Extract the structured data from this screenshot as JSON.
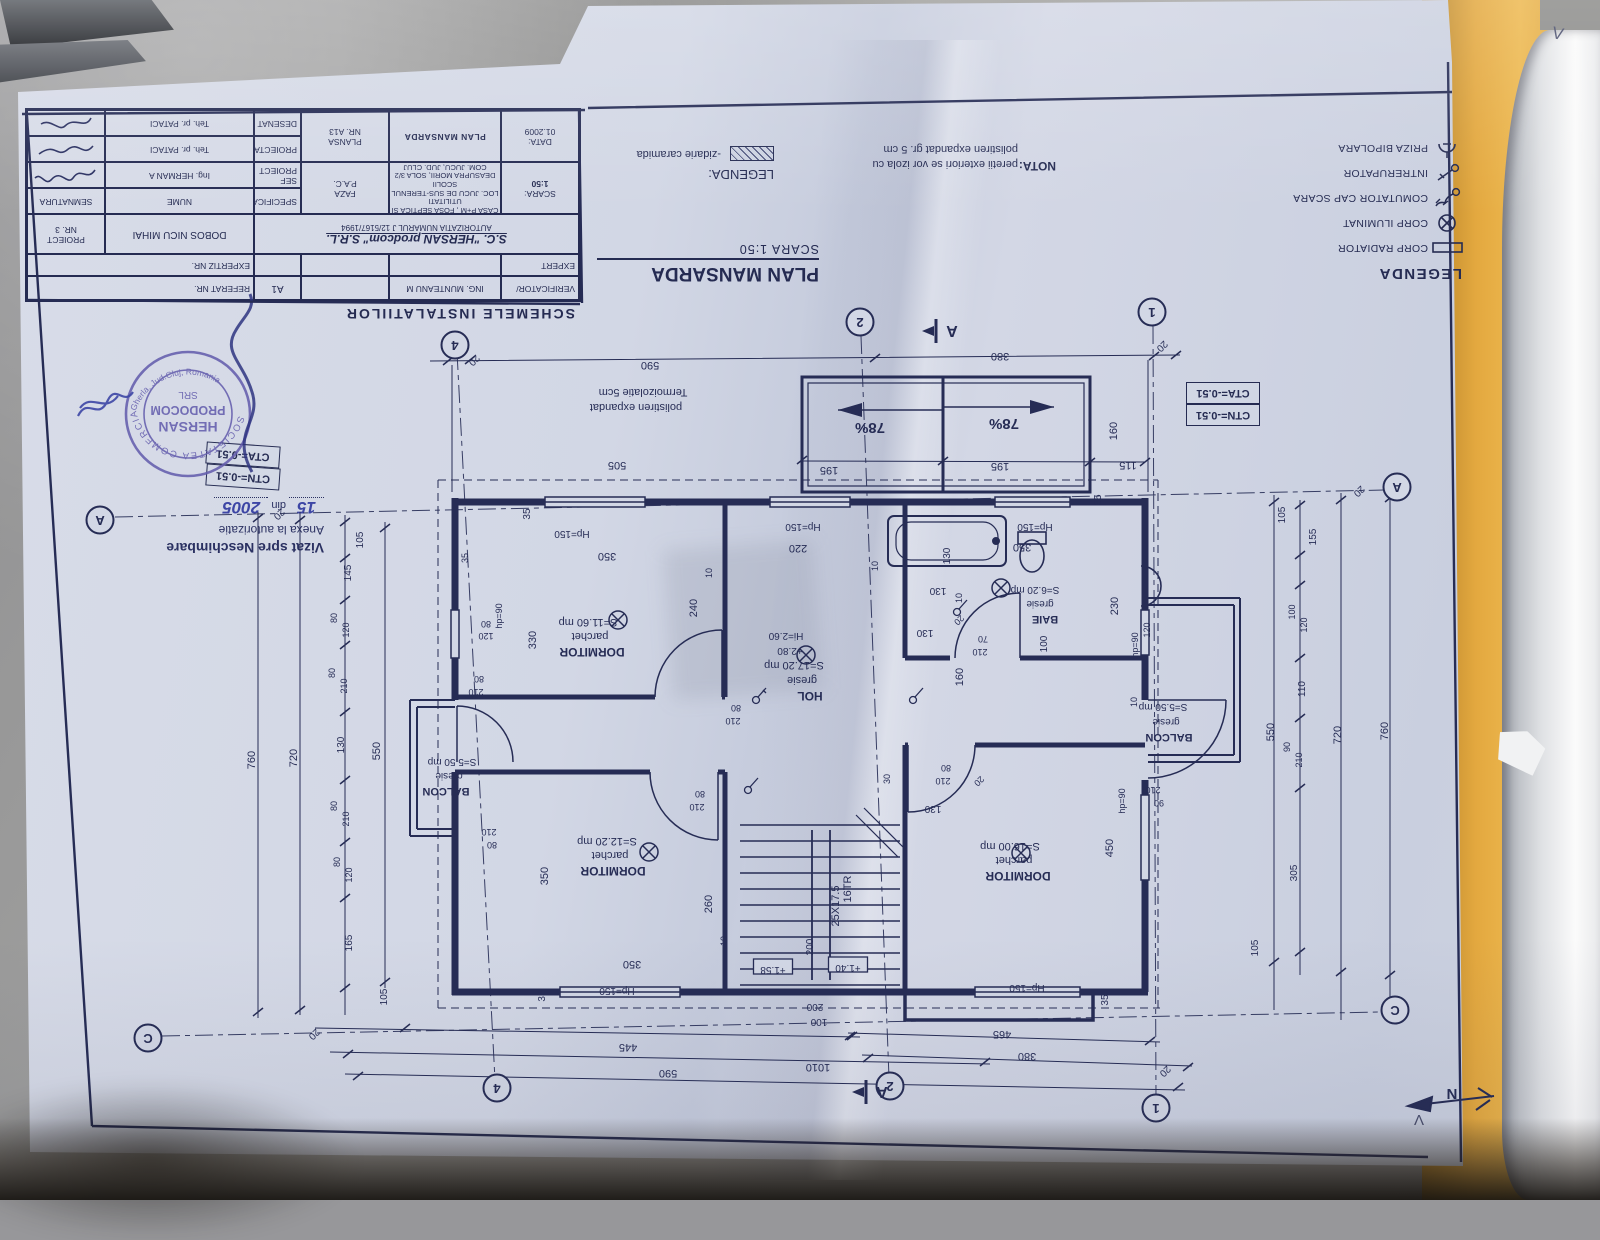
{
  "title_block": {
    "heading": "SCHEMELE INSTALATIILOR",
    "verificator_label": "VERIFICATOR/",
    "verificator_name": "ING. MUNTEANU M",
    "a1": "A1",
    "referat": "REFERAT NR.",
    "expert_label": "EXPERT",
    "expertiz": "EXPERTIZ NR.",
    "firm": "S.C. \"HERSAN prodcom\" S.R.L.",
    "autorizatia": "AUTORIZATIA NUMARUL J 12/5167/1994",
    "beneficiar": "DOBOS NICU MIHAI",
    "proiect_label": "PROIECT",
    "proiect_val": "NR. 3",
    "specificatie": "SPECIFICATIE",
    "nume": "NUME",
    "semnatura": "SEMNATURA",
    "scara_label": "SCARA:",
    "scara_val": "1:50",
    "proj1": "CASA P+M , FOSA SEPTICA SI UTILITATI",
    "proj2": "LOC. JUCU DE SUS-TERENUL SCOLII",
    "proj3": "DEASUPRA MORII, SOLA 3/2",
    "proj4": "COM. JUCU, JUD. CLUJ",
    "faza_label": "FAZA",
    "faza_val": "P.A.C.",
    "sef": "SEF PROIECT",
    "sef_name": "Ing. HERMAN A",
    "proiectat": "PROIECTAT",
    "proiectat_name": "Teh. pr. PATACI",
    "desenat": "DESENAT",
    "desenat_name": "Teh. pr. PATACI",
    "data_label": "DATA:",
    "data_val": "01.2009",
    "title": "PLAN MANSARDA",
    "plansa_label": "PLANSA",
    "plansa_val": "NR. A13"
  },
  "plan_title": {
    "title": "PLAN MANSARDA",
    "scale": "SCARA 1:50"
  },
  "nota": {
    "label": "NOTA:",
    "line1": "peretii exteriori se vor izola cu",
    "line2": "polistiren expandat gr. 5 cm"
  },
  "legend_masonry": {
    "label": "LEGENDA:",
    "item": "-zidarie caramida"
  },
  "legend_electric": {
    "title": "LEGENDA",
    "items": [
      {
        "icon": "radiator-icon",
        "label": "CORP RADIATOR"
      },
      {
        "icon": "lamp-icon",
        "label": "CORP ILUMINAT"
      },
      {
        "icon": "comutator-icon",
        "label": "COMUTATOR CAP SCARA"
      },
      {
        "icon": "intrerupator-icon",
        "label": "INTRERUPATOR"
      },
      {
        "icon": "priza-icon",
        "label": "PRIZA BIPOLARA"
      }
    ]
  },
  "stamp": {
    "outer_top": "SOCIETATEA COMERCIALA",
    "outer_bottom": "Gherla, Jud.Cluj, Romania",
    "line1": "HERSAN",
    "line2": "PRODOCOM",
    "line3": "SRL"
  },
  "vizat": {
    "line1": "Vizat spre Neschimbare",
    "line2": "Anexa la autorizatie",
    "nr": "15",
    "din": "din",
    "year": "2005"
  },
  "cota_boxes": {
    "cta": "CTA=-0.51",
    "ctn": "CTN=-0.51"
  },
  "north_label": "N",
  "handwriting": {
    "mark_top": "V",
    "mark_bottom": "Λ"
  },
  "plan": {
    "section_label": "A",
    "sections": [
      [
        938,
        331
      ],
      [
        868,
        1092
      ]
    ],
    "bubbles": [
      [
        455,
        345,
        "4"
      ],
      [
        860,
        322,
        "2"
      ],
      [
        1152,
        312,
        "1"
      ],
      [
        497,
        1088,
        "4"
      ],
      [
        890,
        1086,
        "2"
      ],
      [
        1156,
        1108,
        "1"
      ],
      [
        100,
        520,
        "A"
      ],
      [
        1397,
        487,
        "A"
      ],
      [
        148,
        1038,
        "C"
      ],
      [
        1395,
        1010,
        "C"
      ]
    ],
    "labels": [
      [
        650,
        362,
        "590",
        11
      ],
      [
        1000,
        353,
        "380",
        11
      ],
      [
        472,
        358,
        "20",
        10,
        -45
      ],
      [
        1160,
        344,
        "20",
        10,
        -45
      ],
      [
        870,
        423,
        "78%",
        15,
        0,
        "b"
      ],
      [
        1004,
        419,
        "78%",
        15,
        0,
        "b"
      ],
      [
        829,
        467,
        "195",
        11
      ],
      [
        1000,
        463,
        "195",
        11
      ],
      [
        1128,
        462,
        "115",
        11
      ],
      [
        1117,
        431,
        "160",
        11,
        90
      ],
      [
        1101,
        500,
        "35",
        10,
        90
      ],
      [
        617,
        462,
        "505",
        11
      ],
      [
        643,
        389,
        "Termoizolatie 5cm",
        11
      ],
      [
        636,
        404,
        "polistiren expandat",
        11
      ],
      [
        277,
        512,
        "20",
        10,
        -45
      ],
      [
        255,
        760,
        "760",
        11,
        90
      ],
      [
        297,
        758,
        "720",
        11,
        90
      ],
      [
        380,
        751,
        "550",
        11,
        90
      ],
      [
        363,
        540,
        "105",
        10,
        90
      ],
      [
        351,
        573,
        "145",
        10,
        90
      ],
      [
        337,
        618,
        "80",
        9,
        90
      ],
      [
        349,
        630,
        "120",
        9,
        90
      ],
      [
        335,
        673,
        "80",
        9,
        90
      ],
      [
        347,
        686,
        "210",
        9,
        90
      ],
      [
        344,
        745,
        "130",
        10,
        90
      ],
      [
        337,
        806,
        "80",
        9,
        90
      ],
      [
        349,
        819,
        "210",
        9,
        90
      ],
      [
        340,
        862,
        "80",
        9,
        90
      ],
      [
        352,
        875,
        "120",
        9,
        90
      ],
      [
        352,
        943,
        "165",
        10,
        90
      ],
      [
        387,
        997,
        "105",
        10,
        90
      ],
      [
        312,
        1032,
        "20",
        10,
        -45
      ],
      [
        1357,
        489,
        "20",
        10,
        -45
      ],
      [
        1388,
        731,
        "760",
        11,
        90
      ],
      [
        1341,
        735,
        "720",
        11,
        90
      ],
      [
        1274,
        732,
        "550",
        11,
        90
      ],
      [
        1285,
        515,
        "105",
        10,
        90
      ],
      [
        1316,
        537,
        "155",
        10,
        90
      ],
      [
        1295,
        612,
        "100",
        9,
        90
      ],
      [
        1307,
        625,
        "120",
        9,
        90
      ],
      [
        1305,
        689,
        "110",
        10,
        90
      ],
      [
        1290,
        747,
        "90",
        9,
        90
      ],
      [
        1302,
        760,
        "210",
        9,
        90
      ],
      [
        1297,
        873,
        "305",
        10,
        90
      ],
      [
        1258,
        948,
        "105",
        10,
        90
      ],
      [
        628,
        1044,
        "445",
        11
      ],
      [
        668,
        1070,
        "590",
        11
      ],
      [
        818,
        1064,
        "1010",
        11
      ],
      [
        1002,
        1031,
        "465",
        11
      ],
      [
        1027,
        1053,
        "380",
        11
      ],
      [
        1163,
        1069,
        "20",
        10,
        -45
      ],
      [
        545,
        996,
        "35",
        10,
        90
      ],
      [
        1108,
        1000,
        "35",
        10,
        90
      ],
      [
        617,
        988,
        "Hp=150",
        10
      ],
      [
        1027,
        985,
        "Hp=150",
        10
      ],
      [
        815,
        1004,
        "200",
        10
      ],
      [
        819,
        1019,
        "100",
        10
      ],
      [
        588,
        619,
        "S=11.60 mp",
        11
      ],
      [
        590,
        633,
        "parchet",
        11
      ],
      [
        592,
        648,
        "DORMITOR",
        12,
        0,
        "b"
      ],
      [
        530,
        514,
        "35",
        10,
        90
      ],
      [
        572,
        531,
        "Hp=150",
        10
      ],
      [
        607,
        553,
        "350",
        11
      ],
      [
        712,
        573,
        "10",
        9,
        90
      ],
      [
        697,
        608,
        "240",
        11,
        90
      ],
      [
        536,
        640,
        "330",
        11,
        90
      ],
      [
        468,
        558,
        "35",
        9,
        90
      ],
      [
        486,
        621,
        "80",
        9
      ],
      [
        486,
        633,
        "120",
        9
      ],
      [
        502,
        616,
        "hp=90",
        9,
        90
      ],
      [
        479,
        676,
        "80",
        9
      ],
      [
        476,
        689,
        "210",
        9
      ],
      [
        736,
        705,
        "80",
        9
      ],
      [
        733,
        718,
        "210",
        9
      ],
      [
        452,
        759,
        "S=5.50 mp",
        10
      ],
      [
        449,
        773,
        "gresie",
        10
      ],
      [
        446,
        788,
        "BALCON",
        11,
        0,
        "b"
      ],
      [
        489,
        829,
        "210",
        9
      ],
      [
        492,
        842,
        "80",
        9
      ],
      [
        607,
        838,
        "S=12.20 mp",
        11
      ],
      [
        610,
        852,
        "parchet",
        11
      ],
      [
        613,
        867,
        "DORMITOR",
        12,
        0,
        "b"
      ],
      [
        548,
        876,
        "350",
        11,
        90
      ],
      [
        632,
        961,
        "350",
        11
      ],
      [
        712,
        904,
        "260",
        11,
        90
      ],
      [
        727,
        941,
        "10",
        9,
        90
      ],
      [
        700,
        791,
        "80",
        9
      ],
      [
        697,
        804,
        "210",
        9
      ],
      [
        786,
        633,
        "Hi=2.60",
        10
      ],
      [
        790,
        648,
        "+2.80",
        10
      ],
      [
        794,
        662,
        "S=17.20 mp",
        11
      ],
      [
        802,
        677,
        "gresie",
        11
      ],
      [
        810,
        692,
        "HOL",
        12,
        0,
        "b"
      ],
      [
        798,
        545,
        "220",
        11
      ],
      [
        803,
        524,
        "Hp=150",
        10
      ],
      [
        878,
        566,
        "10",
        9,
        90
      ],
      [
        950,
        556,
        "130",
        10,
        90
      ],
      [
        938,
        588,
        "130",
        10
      ],
      [
        962,
        598,
        "10",
        9,
        90
      ],
      [
        925,
        630,
        "130",
        10
      ],
      [
        957,
        618,
        "20",
        9,
        -45
      ],
      [
        983,
        636,
        "70",
        9
      ],
      [
        980,
        649,
        "210",
        9
      ],
      [
        963,
        677,
        "160",
        11,
        90
      ],
      [
        890,
        779,
        "30",
        9,
        90
      ],
      [
        946,
        765,
        "80",
        9
      ],
      [
        943,
        778,
        "210",
        9
      ],
      [
        977,
        779,
        "20",
        9,
        -45
      ],
      [
        933,
        806,
        "130",
        10
      ],
      [
        1035,
        587,
        "S=6.20 mp",
        10
      ],
      [
        1040,
        601,
        "gresie",
        10
      ],
      [
        1045,
        616,
        "BAIE",
        11,
        0,
        "b"
      ],
      [
        1022,
        544,
        "350",
        11
      ],
      [
        1035,
        524,
        "Hp=150",
        10
      ],
      [
        1047,
        644,
        "100",
        10,
        90
      ],
      [
        1118,
        606,
        "230",
        11,
        90
      ],
      [
        1163,
        704,
        "S=5.50 mp",
        10
      ],
      [
        1166,
        719,
        "gresie",
        10
      ],
      [
        1169,
        734,
        "BALCON",
        11,
        0,
        "b"
      ],
      [
        1138,
        645,
        "hp=90",
        9,
        90
      ],
      [
        1150,
        630,
        "120",
        9,
        90
      ],
      [
        1137,
        702,
        "10",
        9,
        90
      ],
      [
        1010,
        843,
        "S=16.00 mp",
        11
      ],
      [
        1014,
        857,
        "parchet",
        11
      ],
      [
        1018,
        872,
        "DORMITOR",
        12,
        0,
        "b"
      ],
      [
        1113,
        848,
        "450",
        11,
        90
      ],
      [
        1125,
        801,
        "hp=90",
        9,
        90
      ],
      [
        1153,
        787,
        "210",
        9
      ],
      [
        1159,
        800,
        "90",
        9
      ],
      [
        851,
        889,
        "16TR",
        11,
        90
      ],
      [
        839,
        906,
        "25X17.5",
        11,
        90
      ],
      [
        773,
        967,
        "+1.58",
        10,
        0,
        "x"
      ],
      [
        848,
        965,
        "+1.40",
        10,
        0,
        "x"
      ],
      [
        813,
        947,
        "200",
        10,
        90
      ]
    ],
    "ticks": [
      [
        448,
        361
      ],
      [
        470,
        360
      ],
      [
        875,
        358
      ],
      [
        1154,
        356
      ],
      [
        1176,
        355
      ],
      [
        802,
        460
      ],
      [
        943,
        461
      ],
      [
        1090,
        462
      ],
      [
        1145,
        462
      ],
      [
        345,
        522
      ],
      [
        345,
        558
      ],
      [
        345,
        600
      ],
      [
        345,
        645
      ],
      [
        345,
        712
      ],
      [
        345,
        780
      ],
      [
        345,
        842
      ],
      [
        345,
        898
      ],
      [
        345,
        988
      ],
      [
        300,
        520
      ],
      [
        300,
        1010
      ],
      [
        258,
        518
      ],
      [
        258,
        1012
      ],
      [
        385,
        528
      ],
      [
        385,
        982
      ],
      [
        1300,
        505
      ],
      [
        1300,
        555
      ],
      [
        1300,
        585
      ],
      [
        1300,
        658
      ],
      [
        1300,
        718
      ],
      [
        1300,
        788
      ],
      [
        1300,
        952
      ],
      [
        1274,
        502
      ],
      [
        1274,
        962
      ],
      [
        1341,
        500
      ],
      [
        1341,
        972
      ],
      [
        1390,
        498
      ],
      [
        1390,
        975
      ],
      [
        405,
        1028
      ],
      [
        850,
        1036
      ],
      [
        348,
        1054
      ],
      [
        985,
        1062
      ],
      [
        358,
        1076
      ],
      [
        1178,
        1087
      ],
      [
        852,
        1036
      ],
      [
        1150,
        1041
      ],
      [
        868,
        1058
      ],
      [
        1188,
        1067
      ]
    ]
  }
}
